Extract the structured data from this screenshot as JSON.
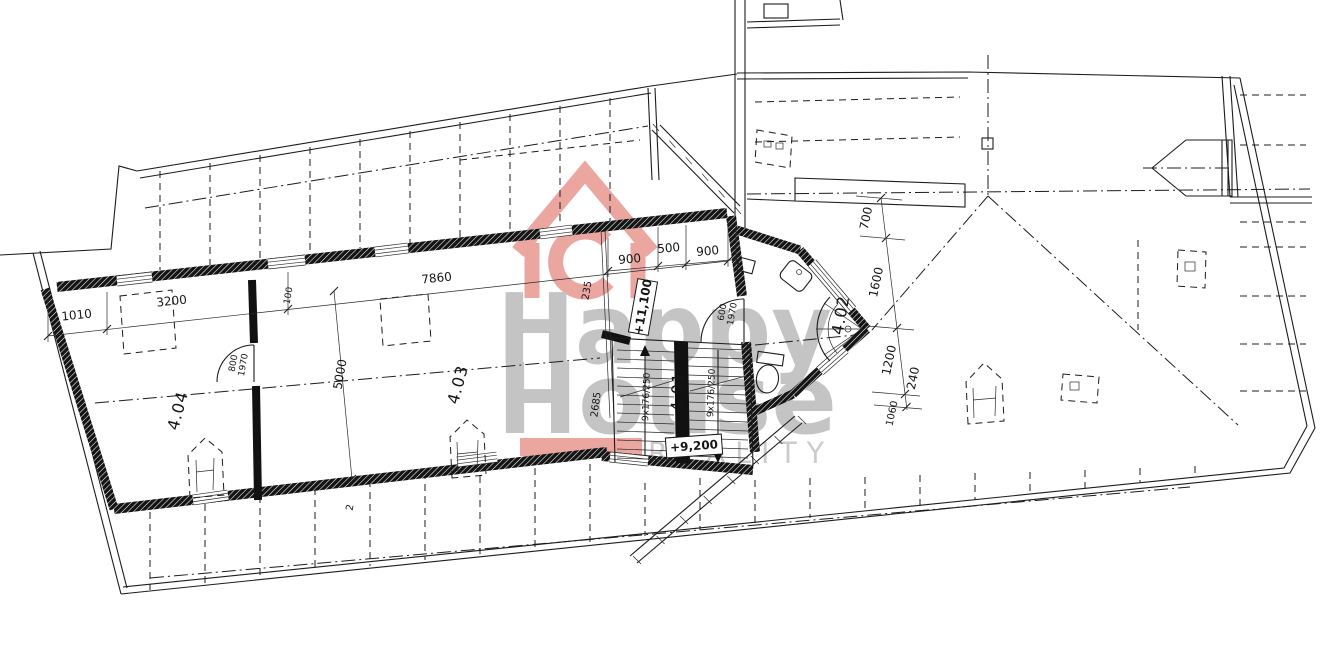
{
  "watermark": {
    "line1": "Happy",
    "line2": "House",
    "line3": "REALITY",
    "red": "#d94f44",
    "gray": "#8a8a8a"
  },
  "rooms": {
    "r404": "4.04",
    "r403": "4.03",
    "r401": "4.01",
    "r402": "4.02"
  },
  "levels": {
    "upper": "+11,100",
    "lower": "+9,200"
  },
  "doors": {
    "d404_w": "800",
    "d404_h": "1970",
    "d402_w": "600",
    "d402_h": "1970"
  },
  "stairs": {
    "left_flight": "9x176/250",
    "right_flight": "9x176/250"
  },
  "dims": {
    "d1010": "1010",
    "d3200": "3200",
    "d100": "100",
    "d7860": "7860",
    "d900a": "900",
    "d500": "500",
    "d900b": "900",
    "d235": "235",
    "d5000": "5000",
    "d2685": "2685",
    "d700": "700",
    "d1600": "1600",
    "d1200": "1200",
    "d240": "240",
    "d1060": "1060",
    "d2": "2"
  }
}
